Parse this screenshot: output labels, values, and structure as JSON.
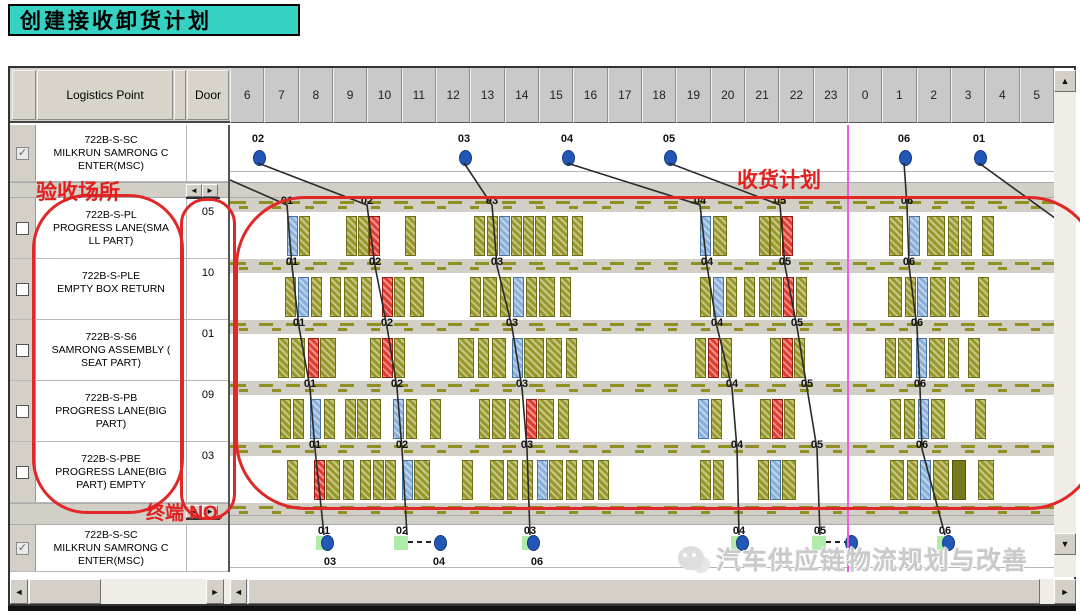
{
  "title": "创建接收卸货计划",
  "annotations": {
    "acceptance_place": "验收场所",
    "receiving_plan": "收货计划",
    "terminal_no": "终端 NO."
  },
  "watermark": "汽车供应链物流规划与改善",
  "icons": {
    "up": "▲",
    "down": "▼",
    "left": "◄",
    "right": "►",
    "check": "✓"
  },
  "table": {
    "headers": {
      "logistics": "Logistics Point",
      "door": "Door"
    },
    "rows": [
      {
        "code": "722B-S-SC",
        "line1": "MILKRUN SAMRONG C",
        "line2": "ENTER(MSC)",
        "door": "",
        "checked": true
      },
      {
        "code": "722B-S-PL",
        "line1": "PROGRESS LANE(SMA",
        "line2": "LL PART)",
        "door": "05",
        "checked": false
      },
      {
        "code": "722B-S-PLE",
        "line1": "EMPTY BOX RETURN",
        "line2": "",
        "door": "10",
        "checked": false
      },
      {
        "code": "722B-S-S6",
        "line1": "SAMRONG ASSEMBLY (",
        "line2": "SEAT PART)",
        "door": "01",
        "checked": false
      },
      {
        "code": "722B-S-PB",
        "line1": "PROGRESS LANE(BIG",
        "line2": "PART)",
        "door": "09",
        "checked": false
      },
      {
        "code": "722B-S-PBE",
        "line1": "PROGRESS LANE(BIG",
        "line2": "PART) EMPTY",
        "door": "03",
        "checked": false
      },
      {
        "code": "722B-S-SC",
        "line1": "MILKRUN SAMRONG C",
        "line2": "ENTER(MSC)",
        "door": "",
        "checked": true
      }
    ]
  },
  "gantt": {
    "hours": [
      "6",
      "7",
      "8",
      "9",
      "10",
      "11",
      "12",
      "13",
      "14",
      "15",
      "16",
      "17",
      "18",
      "19",
      "20",
      "21",
      "22",
      "23",
      "0",
      "1",
      "2",
      "3",
      "4",
      "5"
    ],
    "top_dots": [
      {
        "label": "02",
        "x": 28
      },
      {
        "label": "03",
        "x": 234
      },
      {
        "label": "04",
        "x": 337
      },
      {
        "label": "05",
        "x": 439
      },
      {
        "label": "06",
        "x": 674
      },
      {
        "label": "01",
        "x": 749
      }
    ],
    "rows": [
      {
        "name": "722B-S-PL",
        "labels": [
          {
            "t": "01",
            "x": 57
          },
          {
            "t": "02",
            "x": 137
          },
          {
            "t": "03",
            "x": 262
          },
          {
            "t": "04",
            "x": 470
          },
          {
            "t": "05",
            "x": 550
          },
          {
            "t": "06",
            "x": 677
          }
        ],
        "bars": [
          [
            57,
            "b"
          ],
          [
            69,
            "o"
          ],
          [
            116,
            "o"
          ],
          [
            128,
            "o"
          ],
          [
            139,
            "r"
          ],
          [
            175,
            "o"
          ],
          [
            244,
            "o"
          ],
          [
            257,
            "o"
          ],
          [
            269,
            "b"
          ],
          [
            281,
            "o"
          ],
          [
            293,
            "o"
          ],
          [
            305,
            "o"
          ],
          [
            322,
            "o",
            16
          ],
          [
            342,
            "o"
          ],
          [
            470,
            "b"
          ],
          [
            483,
            "o",
            14
          ],
          [
            529,
            "o"
          ],
          [
            540,
            "o"
          ],
          [
            552,
            "r"
          ],
          [
            659,
            "o",
            14
          ],
          [
            679,
            "b"
          ],
          [
            697,
            "o",
            18
          ],
          [
            718,
            "o"
          ],
          [
            731,
            "o"
          ],
          [
            752,
            "o",
            12
          ]
        ]
      },
      {
        "name": "722B-S-PLE",
        "labels": [
          {
            "t": "01",
            "x": 62
          },
          {
            "t": "02",
            "x": 145
          },
          {
            "t": "03",
            "x": 267
          },
          {
            "t": "04",
            "x": 477
          },
          {
            "t": "05",
            "x": 555
          },
          {
            "t": "06",
            "x": 679
          }
        ],
        "bars": [
          [
            55,
            "o"
          ],
          [
            68,
            "b"
          ],
          [
            81,
            "o"
          ],
          [
            100,
            "o"
          ],
          [
            114,
            "o",
            14
          ],
          [
            131,
            "o"
          ],
          [
            152,
            "r"
          ],
          [
            164,
            "o"
          ],
          [
            180,
            "o",
            14
          ],
          [
            240,
            "o"
          ],
          [
            253,
            "o",
            14
          ],
          [
            270,
            "o"
          ],
          [
            283,
            "b"
          ],
          [
            296,
            "o"
          ],
          [
            309,
            "o",
            16
          ],
          [
            330,
            "o"
          ],
          [
            470,
            "o"
          ],
          [
            483,
            "b"
          ],
          [
            496,
            "o"
          ],
          [
            514,
            "o"
          ],
          [
            529,
            "o"
          ],
          [
            541,
            "o"
          ],
          [
            553,
            "r"
          ],
          [
            566,
            "o"
          ],
          [
            658,
            "o",
            14
          ],
          [
            675,
            "o"
          ],
          [
            687,
            "b"
          ],
          [
            700,
            "o",
            16
          ],
          [
            719,
            "o"
          ],
          [
            748,
            "o"
          ]
        ]
      },
      {
        "name": "722B-S-S6",
        "labels": [
          {
            "t": "01",
            "x": 69
          },
          {
            "t": "02",
            "x": 157
          },
          {
            "t": "03",
            "x": 282
          },
          {
            "t": "04",
            "x": 487
          },
          {
            "t": "05",
            "x": 567
          },
          {
            "t": "06",
            "x": 687
          }
        ],
        "bars": [
          [
            48,
            "o"
          ],
          [
            61,
            "o",
            14
          ],
          [
            78,
            "r"
          ],
          [
            90,
            "o",
            16
          ],
          [
            140,
            "o"
          ],
          [
            152,
            "r"
          ],
          [
            164,
            "o"
          ],
          [
            228,
            "o",
            16
          ],
          [
            248,
            "o"
          ],
          [
            262,
            "o",
            14
          ],
          [
            282,
            "b"
          ],
          [
            294,
            "o",
            20
          ],
          [
            316,
            "o",
            16
          ],
          [
            336,
            "o"
          ],
          [
            465,
            "o"
          ],
          [
            478,
            "r"
          ],
          [
            491,
            "o"
          ],
          [
            540,
            "o"
          ],
          [
            552,
            "r"
          ],
          [
            564,
            "o"
          ],
          [
            655,
            "o"
          ],
          [
            668,
            "o",
            14
          ],
          [
            686,
            "b"
          ],
          [
            699,
            "o",
            16
          ],
          [
            718,
            "o"
          ],
          [
            738,
            "o",
            12
          ]
        ]
      },
      {
        "name": "722B-S-PB",
        "labels": [
          {
            "t": "01",
            "x": 80
          },
          {
            "t": "02",
            "x": 167
          },
          {
            "t": "03",
            "x": 292
          },
          {
            "t": "04",
            "x": 502
          },
          {
            "t": "05",
            "x": 577
          },
          {
            "t": "06",
            "x": 690
          }
        ],
        "bars": [
          [
            50,
            "o"
          ],
          [
            63,
            "o"
          ],
          [
            80,
            "b"
          ],
          [
            94,
            "o"
          ],
          [
            115,
            "o"
          ],
          [
            127,
            "o"
          ],
          [
            140,
            "o"
          ],
          [
            163,
            "b"
          ],
          [
            176,
            "o"
          ],
          [
            200,
            "o"
          ],
          [
            249,
            "o"
          ],
          [
            262,
            "o",
            14
          ],
          [
            279,
            "o"
          ],
          [
            296,
            "r"
          ],
          [
            308,
            "o",
            16
          ],
          [
            328,
            "o"
          ],
          [
            468,
            "b"
          ],
          [
            481,
            "o"
          ],
          [
            530,
            "o"
          ],
          [
            542,
            "r"
          ],
          [
            554,
            "o"
          ],
          [
            660,
            "o"
          ],
          [
            674,
            "o"
          ],
          [
            688,
            "b"
          ],
          [
            701,
            "o",
            14
          ],
          [
            745,
            "o"
          ]
        ]
      },
      {
        "name": "722B-S-PBE",
        "labels": [
          {
            "t": "01",
            "x": 85
          },
          {
            "t": "02",
            "x": 172
          },
          {
            "t": "03",
            "x": 297
          },
          {
            "t": "04",
            "x": 507
          },
          {
            "t": "05",
            "x": 587
          },
          {
            "t": "06",
            "x": 692
          }
        ],
        "bars": [
          [
            57,
            "o"
          ],
          [
            84,
            "r"
          ],
          [
            96,
            "o",
            14
          ],
          [
            113,
            "o"
          ],
          [
            130,
            "o"
          ],
          [
            143,
            "o"
          ],
          [
            155,
            "o"
          ],
          [
            172,
            "b"
          ],
          [
            184,
            "o",
            16
          ],
          [
            232,
            "o"
          ],
          [
            260,
            "o",
            14
          ],
          [
            277,
            "o"
          ],
          [
            292,
            "o"
          ],
          [
            307,
            "b"
          ],
          [
            319,
            "o",
            14
          ],
          [
            336,
            "o"
          ],
          [
            352,
            "o",
            12
          ],
          [
            368,
            "o"
          ],
          [
            470,
            "o"
          ],
          [
            483,
            "o"
          ],
          [
            528,
            "o"
          ],
          [
            540,
            "b"
          ],
          [
            552,
            "o",
            14
          ],
          [
            660,
            "o",
            14
          ],
          [
            677,
            "o"
          ],
          [
            690,
            "b"
          ],
          [
            703,
            "o",
            16
          ],
          [
            722,
            "d",
            14
          ],
          [
            748,
            "o",
            16
          ]
        ]
      }
    ],
    "bottom_dots": [
      {
        "label": "01",
        "x": 94,
        "type": "dot"
      },
      {
        "label": "02",
        "x": 172,
        "type": "green",
        "dash_to": 209
      },
      {
        "label": "03",
        "x": 300,
        "type": "dot"
      },
      {
        "label": "04",
        "x": 509,
        "type": "dot"
      },
      {
        "label": "05",
        "x": 590,
        "type": "green",
        "dash_to": 620
      },
      {
        "label": "06",
        "x": 715,
        "type": "dot"
      }
    ],
    "sub_labels": [
      {
        "t": "03",
        "x": 100
      },
      {
        "t": "04",
        "x": 209
      },
      {
        "t": "06",
        "x": 307
      }
    ],
    "chains": [
      {
        "pts": [
          [
            0,
            55
          ],
          [
            57,
            80
          ],
          [
            62,
            141
          ],
          [
            69,
            202
          ],
          [
            80,
            263
          ],
          [
            85,
            324
          ],
          [
            94,
            410
          ]
        ]
      },
      {
        "pts": [
          [
            28,
            38
          ],
          [
            137,
            80
          ],
          [
            145,
            141
          ],
          [
            157,
            202
          ],
          [
            167,
            263
          ],
          [
            172,
            324
          ],
          [
            177,
            410
          ]
        ]
      },
      {
        "pts": [
          [
            234,
            38
          ],
          [
            262,
            80
          ],
          [
            267,
            141
          ],
          [
            282,
            202
          ],
          [
            292,
            263
          ],
          [
            297,
            324
          ],
          [
            300,
            410
          ]
        ]
      },
      {
        "pts": [
          [
            337,
            38
          ],
          [
            470,
            80
          ],
          [
            477,
            141
          ],
          [
            487,
            202
          ],
          [
            502,
            263
          ],
          [
            507,
            324
          ],
          [
            509,
            410
          ]
        ]
      },
      {
        "pts": [
          [
            439,
            38
          ],
          [
            550,
            80
          ],
          [
            555,
            141
          ],
          [
            567,
            202
          ],
          [
            577,
            263
          ],
          [
            587,
            324
          ],
          [
            590,
            410
          ]
        ]
      },
      {
        "pts": [
          [
            674,
            38
          ],
          [
            677,
            80
          ],
          [
            679,
            141
          ],
          [
            687,
            202
          ],
          [
            690,
            263
          ],
          [
            692,
            324
          ],
          [
            715,
            410
          ]
        ]
      },
      {
        "pts": [
          [
            749,
            38
          ],
          [
            862,
            120
          ]
        ]
      }
    ],
    "colors": {
      "olive": "#99992b",
      "blue": "#8ab0da",
      "red": "#e23b30",
      "dot_blue": "#2257b8",
      "green": "#a6eaa0",
      "magenta": "#ee5ce8",
      "annotation_red": "#e02828"
    }
  }
}
